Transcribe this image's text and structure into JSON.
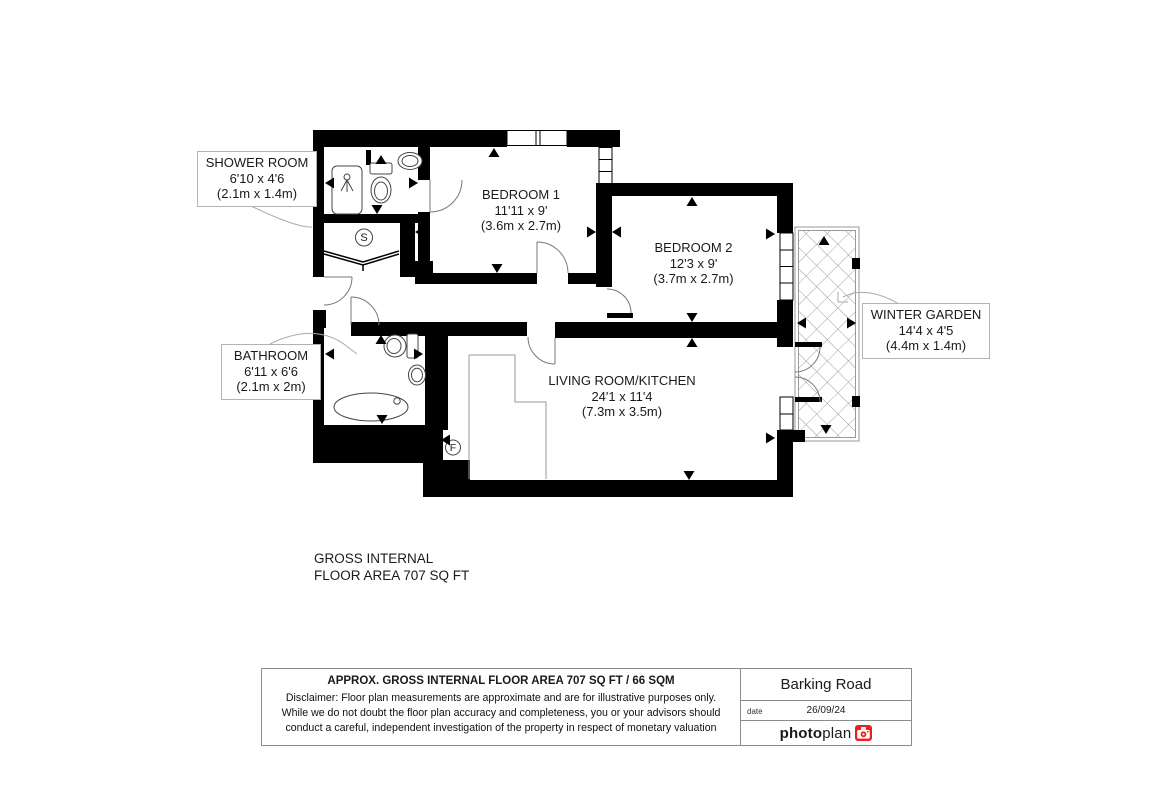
{
  "plan": {
    "rooms": {
      "shower_room": {
        "name": "SHOWER ROOM",
        "size_imperial": "6'10 x 4'6",
        "size_metric": "(2.1m x 1.4m)"
      },
      "bedroom_1": {
        "name": "BEDROOM 1",
        "size_imperial": "11'11 x 9'",
        "size_metric": "(3.6m x 2.7m)"
      },
      "bedroom_2": {
        "name": "BEDROOM 2",
        "size_imperial": "12'3 x 9'",
        "size_metric": "(3.7m x 2.7m)"
      },
      "bathroom": {
        "name": "BATHROOM",
        "size_imperial": "6'11 x 6'6",
        "size_metric": "(2.1m x 2m)"
      },
      "living_room_kitchen": {
        "name": "LIVING ROOM/KITCHEN",
        "size_imperial": "24'1 x 11'4",
        "size_metric": "(7.3m x 3.5m)"
      },
      "winter_garden": {
        "name": "WINTER GARDEN",
        "size_imperial": "14'4 x 4'5",
        "size_metric": "(4.4m x 1.4m)"
      }
    },
    "markers": {
      "storage": "S",
      "fridge_freezer": "F"
    },
    "area_note": {
      "line1": "GROSS INTERNAL",
      "line2": "FLOOR AREA 707 SQ FT"
    }
  },
  "footer": {
    "area_title": "APPROX. GROSS INTERNAL FLOOR AREA 707 SQ FT / 66 SQM",
    "disclaimer": {
      "line1": "Disclaimer: Floor plan measurements are approximate and are for illustrative purposes only.",
      "line2": "While we do not doubt the floor plan accuracy and completeness, you or your advisors should",
      "line3": "conduct a careful, independent investigation of the property in respect of monetary valuation"
    },
    "address": "Barking Road",
    "date_label": "date",
    "date_value": "26/09/24",
    "brand": {
      "name_bold": "photo",
      "name_light": "plan",
      "accent_color": "#e8211d"
    }
  }
}
